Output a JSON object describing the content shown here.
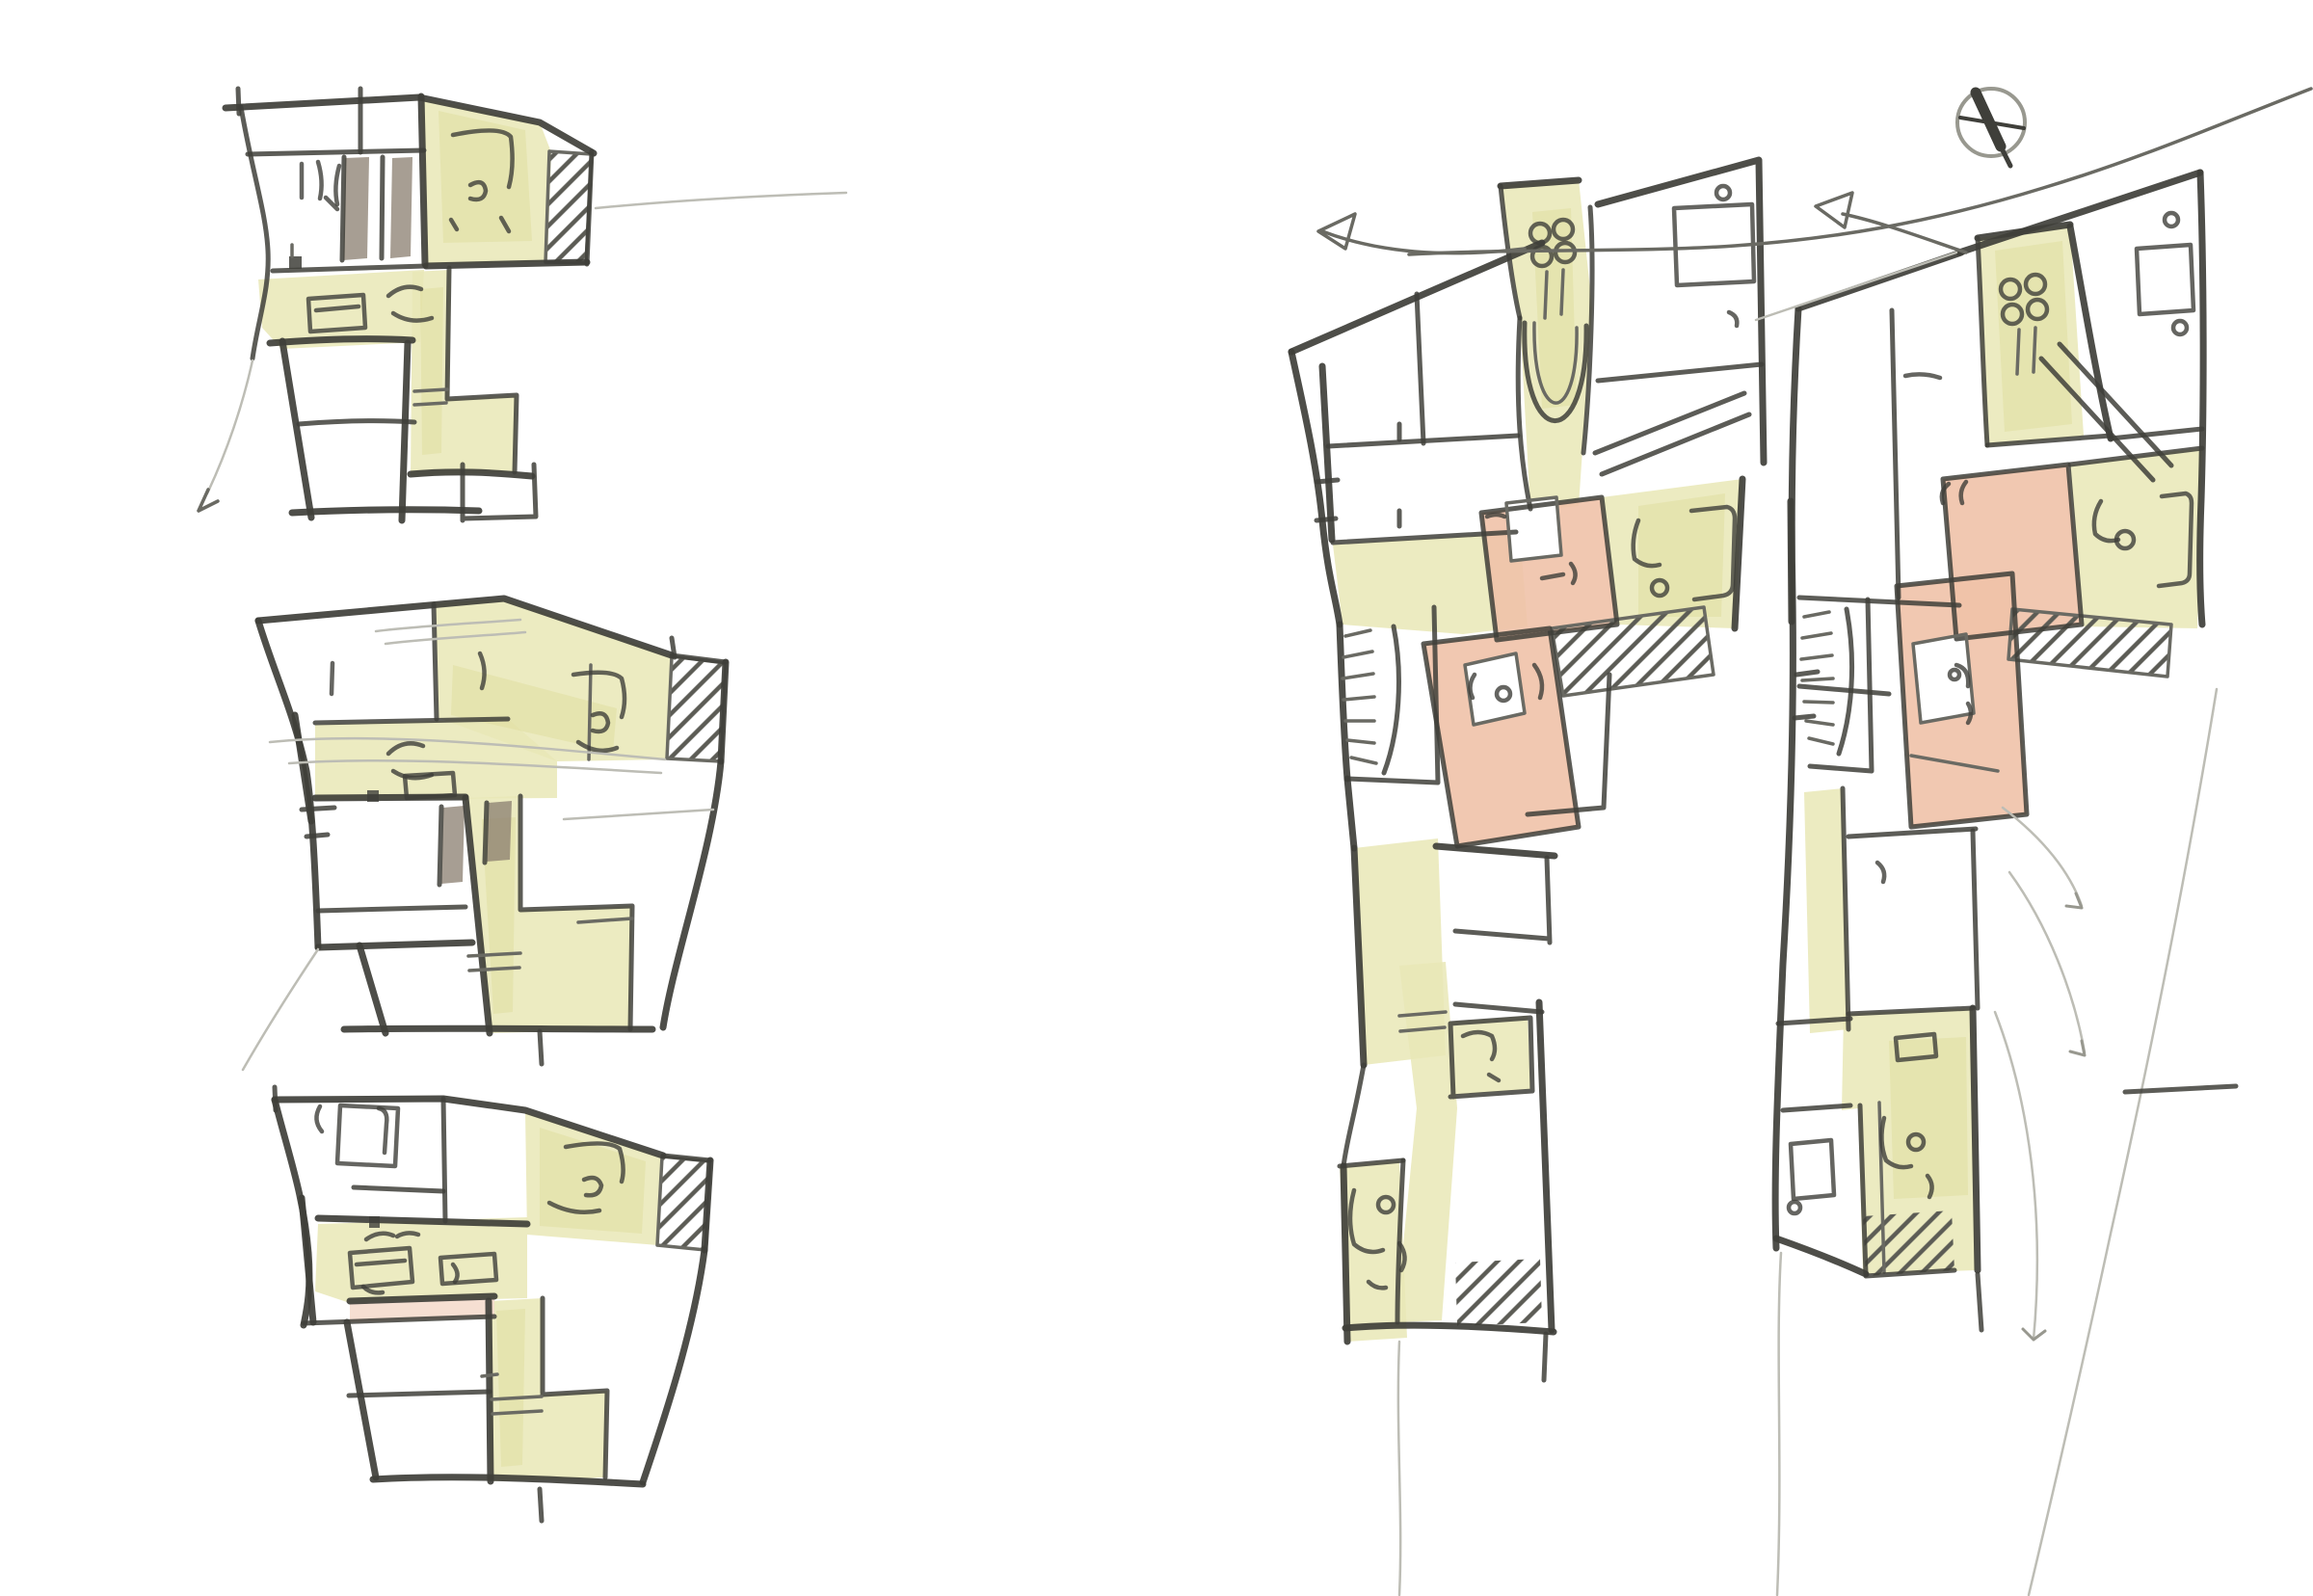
{
  "palette": {
    "paper": "#ffffff",
    "pencil_dark": "#3f3f3a",
    "pencil_medium": "#6a6a63",
    "pencil_light": "#98988f",
    "pencil_faint": "#bdbdb5",
    "wash_yellow": "#e9e7b6",
    "wash_yellow_deep": "#dedc9a",
    "wash_salmon": "#f0c2a8",
    "wash_salmon_pale": "#f5dccd",
    "wash_brown": "#8a7e6f",
    "hatch_stroke": "#5c5c55"
  },
  "sketch": {
    "kind": "hand-drawn architectural floor-plan concept sketches",
    "left_column_plans": [
      "floor-plan-variant-1",
      "floor-plan-variant-2",
      "floor-plan-variant-3"
    ],
    "right_column_plans": [
      "unit-plan-left",
      "unit-plan-right"
    ],
    "washes": [
      "yellow circulation and living spaces",
      "salmon rooms",
      "pale-pink corridor strip",
      "brown door leaves"
    ],
    "symbols": [
      "north-compass",
      "direction-arrows",
      "flow-arrows",
      "stair-fans",
      "diagonal-hatch-shafts",
      "entry-clover-marks"
    ]
  }
}
